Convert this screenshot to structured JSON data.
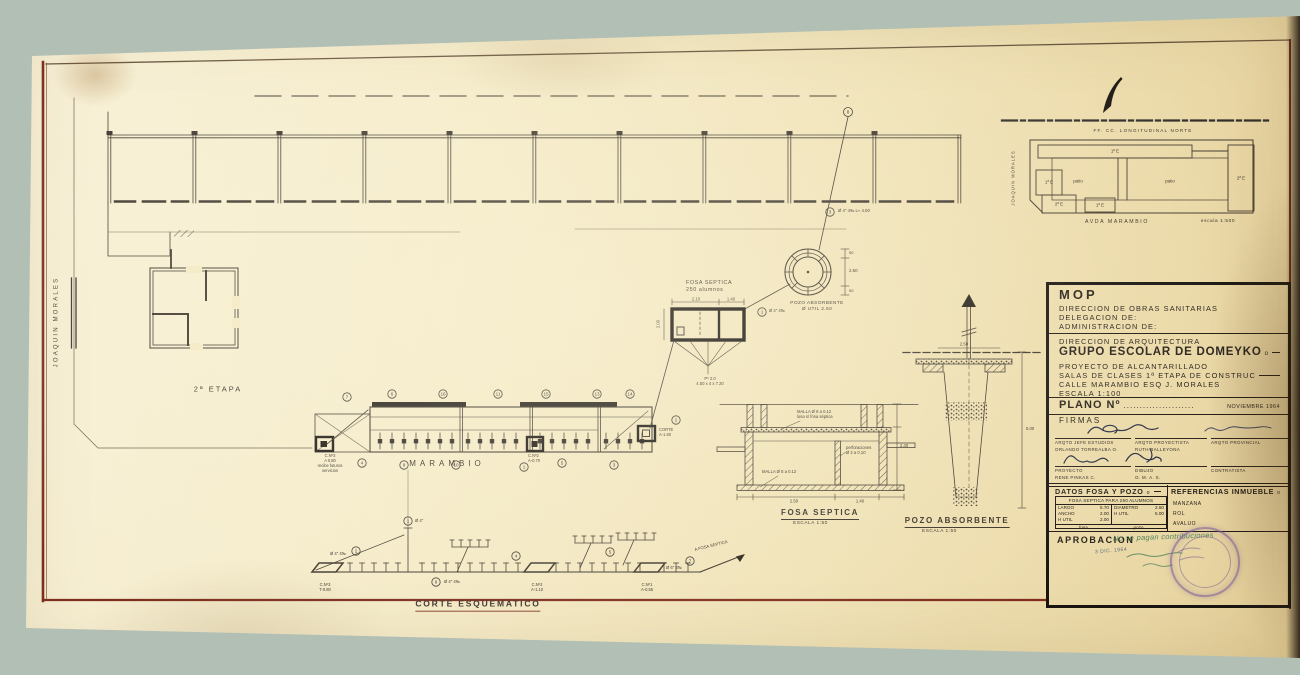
{
  "palette": {
    "bg": "#b2bfb4",
    "paper": "#f5ebc9",
    "ink": "#3b342b",
    "maroon": "#7e2e1e",
    "green_ink": "#3f7a52",
    "stamp": "#7d5f93"
  },
  "main_plan": {
    "street_left": "JOAQUIN MORALES",
    "stage": "2ª ETAPA",
    "street_bottom": "MARAMBIO",
    "chamber_note": "C.Nº3\nA 0.80\nrecibe futuros\nservicios",
    "corte_note": "CORTE\nA-1.50",
    "cam2_note": "C.Nº2\nA-0.70",
    "pipe_note": "Ø 4\" 4‰  L≈ 4.00"
  },
  "fosa_plan": {
    "label": "FOSA SEPTICA\n250 alumnos",
    "dim_a": "2.10",
    "dim_b": "1.40",
    "dim_left": "2.00",
    "note": "Pº 2.0\n4.50 x 4 x 7.20"
  },
  "pozo_plan": {
    "label": "POZO ABSORBENTE\nØ UTIL 2.50",
    "dim": "2.50",
    "dim_top": "50",
    "dim_bottom": "50",
    "pipe_note": "Ø 4\" 4‰"
  },
  "fosa_section": {
    "caption": "FOSA SEPTICA",
    "scale": "ESCALA 1:50",
    "ann_top": "MALLA Ø 8 a 0.12\nlosa s/ fosa séptica",
    "ann_perf": "perforaciones\nØ 2 a 0.10",
    "ann_bottom": "MALLA Ø 8 a 0.12",
    "dim_right": "2.40",
    "dim_b1": "2.50",
    "dim_b2": "1.40"
  },
  "pozo_section": {
    "caption": "POZO ABSORBENTE",
    "scale": "ESCALA 1:50",
    "dim_right": "5.00",
    "dim_top": "2.50"
  },
  "corte": {
    "caption": "CORTE ESQUEMATICO",
    "cam3": "C.Nº3\nT-0.80",
    "cam2": "C.Nº2\nA-1.10",
    "cam1": "C.Nº1\nA-0.55",
    "to_fosa": "A FOSA SEPTICA",
    "riser_note": "Ø 4\"",
    "left_note": "Ø 4\" 4‰",
    "right_note": "Ø 6\" 3‰",
    "under_note": "Ø 4\" 4‰"
  },
  "callouts": [
    "7",
    "6",
    "16",
    "11",
    "15",
    "13",
    "14",
    "4",
    "9",
    "10",
    "1",
    "5",
    "3",
    "2",
    "8",
    "3",
    "1",
    "1",
    "2",
    "7",
    "6",
    "4",
    "5"
  ],
  "site_plan": {
    "railway": "FF. CC. LONGITUDINAL NORTE",
    "street_left": "JOAQUIN MORALES",
    "street_bottom": "AVDA MARAMBIO",
    "scale": "escala 1:500",
    "top_wing": "1ª E",
    "right_wing": "2ª E",
    "left_upper": "1ª E",
    "left_lower": "2ª E",
    "bottom_wing": "1ª E",
    "patio_left": "patio",
    "patio_right": "patio"
  },
  "title_block": {
    "agency": "MOP",
    "org1": "DIRECCION DE OBRAS SANITARIAS",
    "org2": "DELEGACION DE:",
    "org3": "ADMINISTRACION DE:",
    "dept": "DIRECCION DE ARQUITECTURA",
    "project": "GRUPO ESCOLAR DE DOMEYKO",
    "project_suffix": "o",
    "subject1": "PROYECTO DE ALCANTARILLADO",
    "subject2": "SALAS DE CLASES  1ª ETAPA DE CONSTRUC",
    "subject3": "CALLE MARAMBIO ESQ  J. MORALES",
    "scale": "ESCALA 1:100",
    "plano_label": "PLANO Nº",
    "plano_dots": "......................",
    "date": "NOVIEMBRE 1964",
    "firmas_label": "FIRMAS",
    "sig": [
      {
        "role": "ARQTO JEFE ESTUDIOS",
        "name": "ORLANDO TORREALBA O."
      },
      {
        "role": "ARQTO PROYECTISTA",
        "name": "RUTH BALLEYONA"
      },
      {
        "role": "ARQTO PROVINCIAL",
        "name": ""
      },
      {
        "role": "PROYECTO",
        "name": "RENE PINKAS C."
      },
      {
        "role": "DIBUJO",
        "name": "O. M. A. S."
      },
      {
        "role": "CONTRATISTA",
        "name": ""
      }
    ],
    "datos": {
      "header": "DATOS FOSA Y POZO",
      "suffix": "o",
      "sub": "FOSA SEPTICA PARA 250 ALUMNOS",
      "rows_left": [
        [
          "LARGO",
          "5.70"
        ],
        [
          "ANCHO",
          "2.00"
        ],
        [
          "H UTIL",
          "2.00"
        ]
      ],
      "rows_right": [
        [
          "DIAMETRO",
          "2.50"
        ],
        [
          "H UTIL",
          "5.00"
        ]
      ],
      "footer_left": "fosa",
      "footer_right": "pozo"
    },
    "referencias": {
      "header": "REFERENCIAS INMUEBLE",
      "suffix": "o",
      "rows": [
        "MANZANA",
        "ROL",
        "AVALUO"
      ]
    },
    "aprobacion": {
      "label": "APROBACION",
      "note": "No se pagan contribuciones",
      "date": "3 DIC. 1964"
    }
  }
}
